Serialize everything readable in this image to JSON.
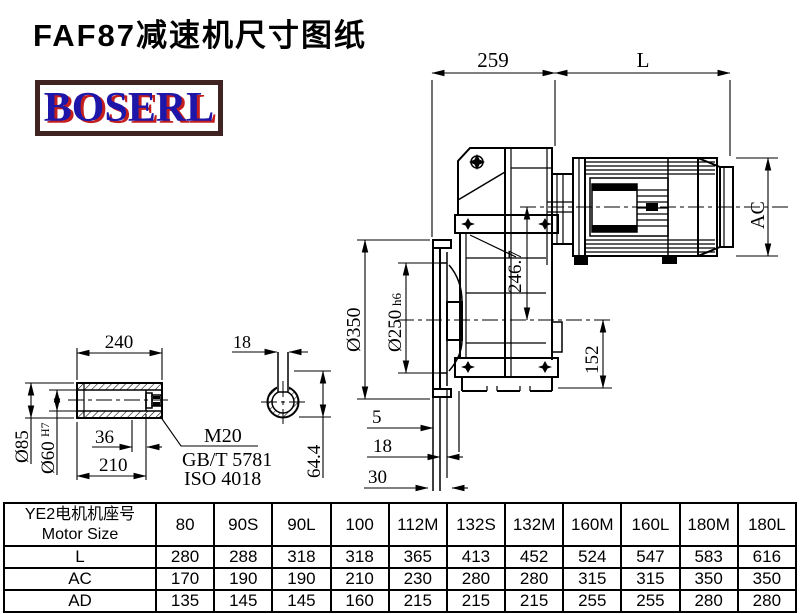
{
  "title": "FAF87减速机尺寸图纸",
  "logo": {
    "text": "BOSERL"
  },
  "drawing": {
    "dims": {
      "gear_unit_length": "259",
      "motor_length": "L",
      "motor_diameter": "AC",
      "flange_od": "Ø350",
      "flange_spigot": "Ø250",
      "flange_spigot_tol": "h6",
      "input_center_height": "246.7",
      "center_to_bottom": "152",
      "flange_step1": "5",
      "flange_step2": "18",
      "flange_step3": "30",
      "shaft_length": "240",
      "shaft_od": "Ø85",
      "shaft_bore": "Ø60",
      "shaft_bore_tol": "H7",
      "bore_depth": "36",
      "shaft_usable_length": "210",
      "bolt_thread": "M20",
      "bolt_standard_gb": "GB/T 5781",
      "bolt_standard_iso": "ISO 4018",
      "keyway_width": "18",
      "keyway_depth": "64.4"
    }
  },
  "table": {
    "header_cn": "YE2电机机座号",
    "header_en": "Motor Size",
    "columns": [
      "80",
      "90S",
      "90L",
      "100",
      "112M",
      "132S",
      "132M",
      "160M",
      "160L",
      "180M",
      "180L"
    ],
    "rows": [
      {
        "label": "L",
        "values": [
          "280",
          "288",
          "318",
          "318",
          "365",
          "413",
          "452",
          "524",
          "547",
          "583",
          "616"
        ]
      },
      {
        "label": "AC",
        "values": [
          "170",
          "190",
          "190",
          "210",
          "230",
          "280",
          "280",
          "315",
          "315",
          "350",
          "350"
        ]
      },
      {
        "label": "AD",
        "values": [
          "135",
          "145",
          "145",
          "160",
          "215",
          "215",
          "215",
          "255",
          "255",
          "280",
          "280"
        ]
      }
    ]
  }
}
